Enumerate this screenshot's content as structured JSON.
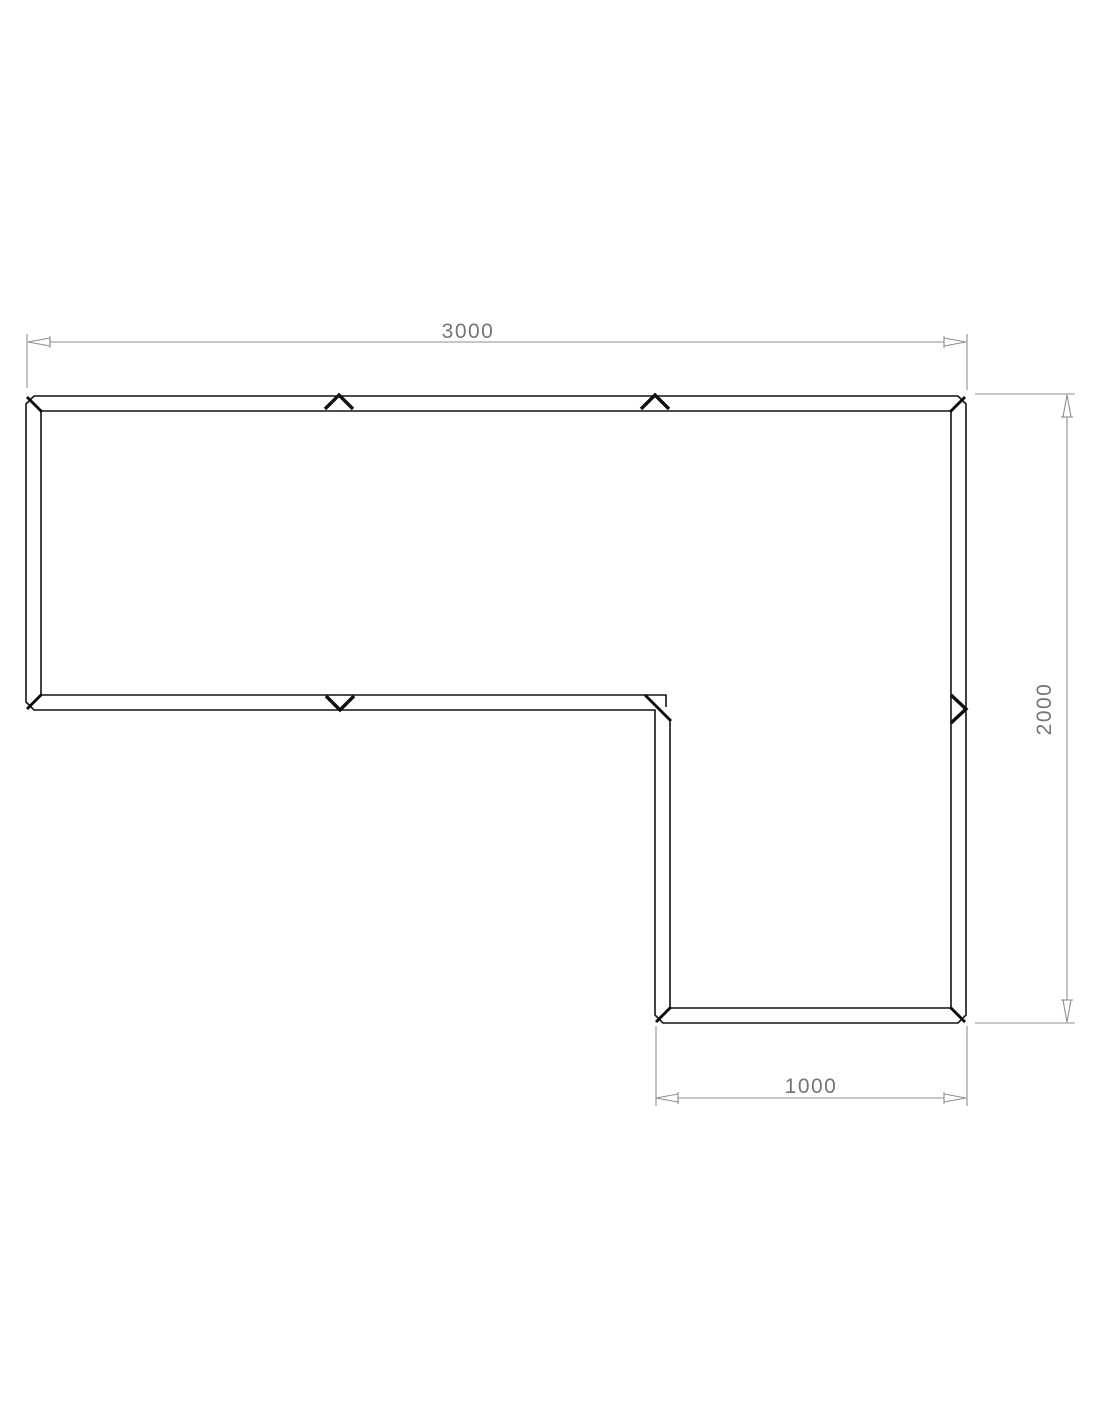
{
  "drawing": {
    "kind": "technical-plan-drawing",
    "shape": "l-shaped-modular-frame",
    "background_color": "#ffffff",
    "outline_color": "#141414",
    "dimension_line_color": "#8f8f8f",
    "dimension_text_color": "#757575",
    "dimensions": {
      "top": {
        "label": "3000",
        "orientation": "horizontal"
      },
      "right": {
        "label": "2000",
        "orientation": "vertical"
      },
      "bottom": {
        "label": "1000",
        "orientation": "horizontal"
      }
    },
    "joint_marks": {
      "top_edge_count": 2,
      "inner_bottom_edge_count": 1,
      "right_edge_count": 1
    }
  }
}
